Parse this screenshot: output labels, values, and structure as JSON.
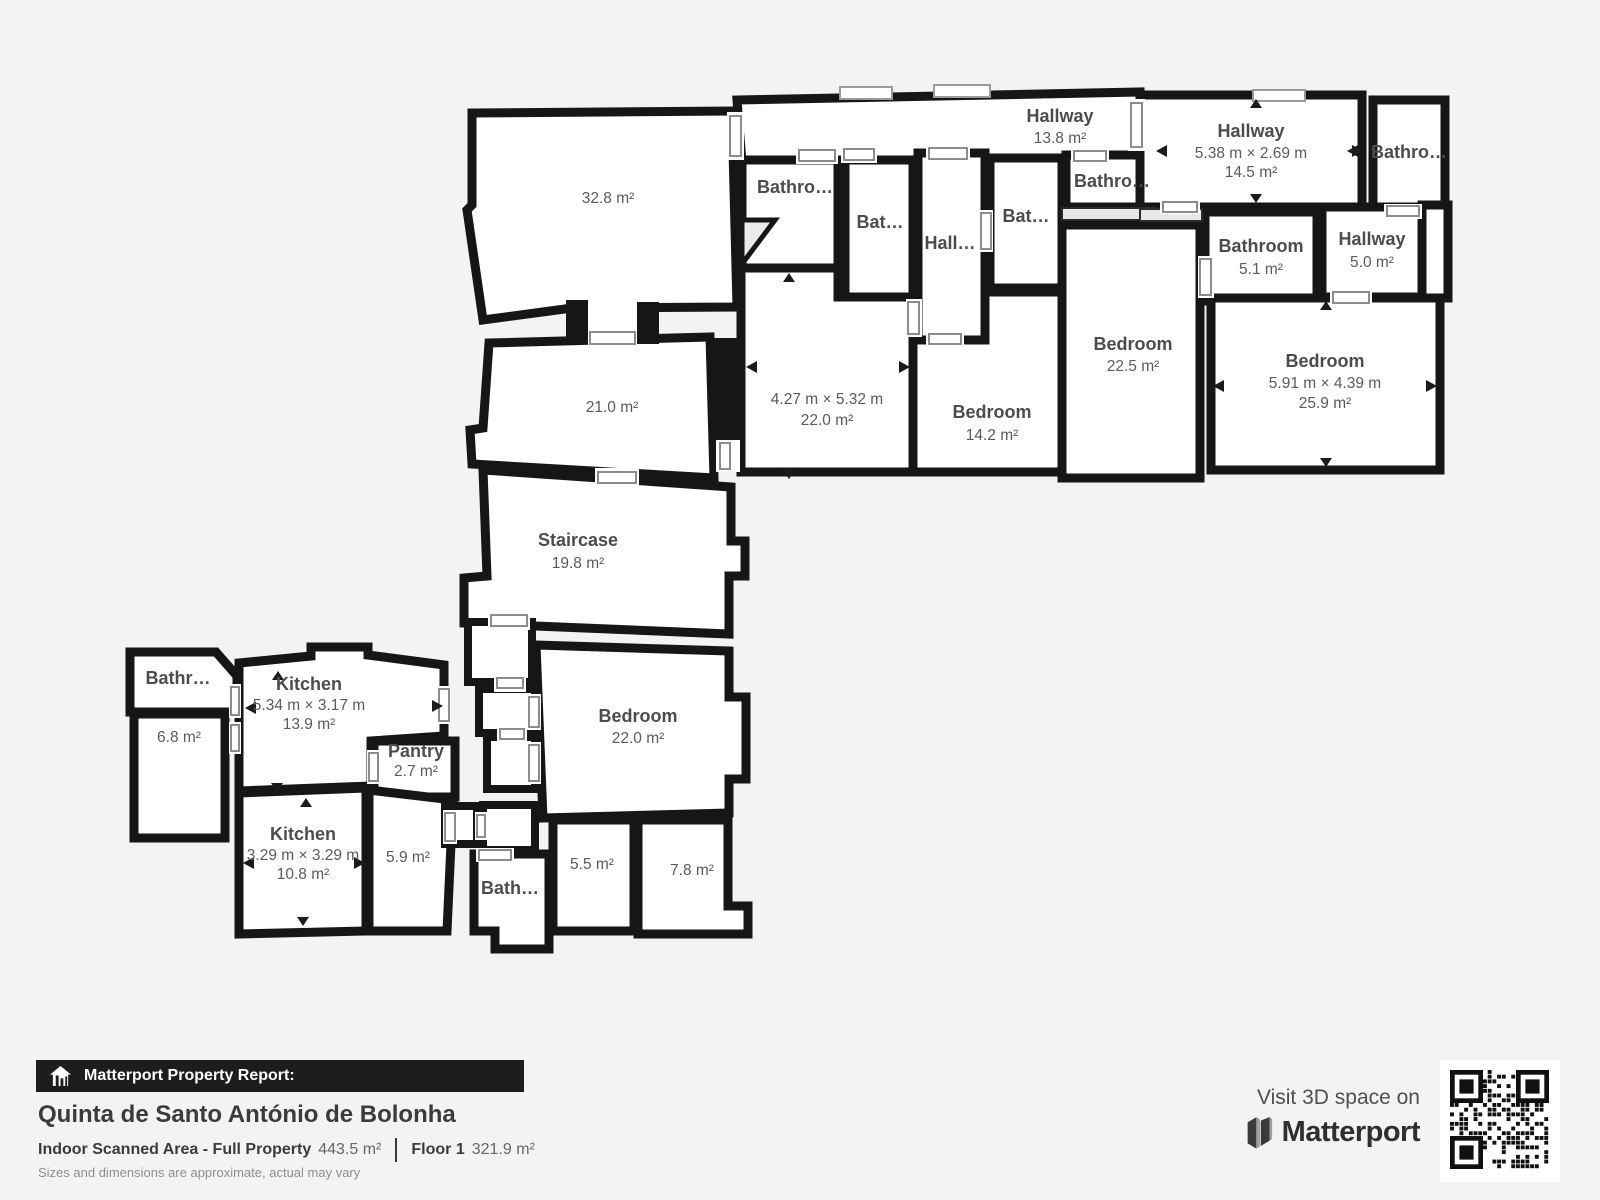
{
  "canvas": {
    "background": "#f4f3f2",
    "wall_color": "#161616",
    "room_fill": "#ffffff",
    "label_color": "#4c4c4c"
  },
  "rooms": [
    {
      "id": "room-32-8",
      "area": "32.8 m²"
    },
    {
      "id": "room-21-0",
      "area": "21.0 m²"
    },
    {
      "id": "staircase",
      "name": "Staircase",
      "area": "19.8 m²"
    },
    {
      "id": "hallway-top",
      "name": "Hallway",
      "area": "13.8 m²"
    },
    {
      "id": "bathroom-strip-left",
      "name": "Bathro…"
    },
    {
      "id": "bath-strip-1",
      "name": "Bat…"
    },
    {
      "id": "hall-corridor",
      "name": "Hall…"
    },
    {
      "id": "bath-strip-2",
      "name": "Bat…"
    },
    {
      "id": "bathroom-strip-right",
      "name": "Bathro…"
    },
    {
      "id": "hallway-right",
      "name": "Hallway",
      "dims": "5.38 m × 2.69 m",
      "area": "14.5 m²"
    },
    {
      "id": "bathroom-top-right",
      "name": "Bathro…"
    },
    {
      "id": "bathroom-5-1",
      "name": "Bathroom",
      "area": "5.1 m²"
    },
    {
      "id": "hallway-5-0",
      "name": "Hallway",
      "area": "5.0 m²"
    },
    {
      "id": "room-22-0",
      "dims": "4.27 m × 5.32 m",
      "area": "22.0 m²"
    },
    {
      "id": "bedroom-14-2",
      "name": "Bedroom",
      "area": "14.2 m²"
    },
    {
      "id": "bedroom-22-5",
      "name": "Bedroom",
      "area": "22.5 m²"
    },
    {
      "id": "bedroom-25-9",
      "name": "Bedroom",
      "dims": "5.91 m × 4.39 m",
      "area": "25.9 m²"
    },
    {
      "id": "bathroom-lower-left",
      "name": "Bathr…"
    },
    {
      "id": "room-6-8",
      "area": "6.8 m²"
    },
    {
      "id": "kitchen-13-9",
      "name": "Kitchen",
      "dims": "5.34 m × 3.17 m",
      "area": "13.9 m²"
    },
    {
      "id": "pantry",
      "name": "Pantry",
      "area": "2.7 m²"
    },
    {
      "id": "kitchen-10-8",
      "name": "Kitchen",
      "dims": "3.29 m × 3.29 m",
      "area": "10.8 m²"
    },
    {
      "id": "room-5-9",
      "area": "5.9 m²"
    },
    {
      "id": "bedroom-22-0",
      "name": "Bedroom",
      "area": "22.0 m²"
    },
    {
      "id": "bath-lower",
      "name": "Bath…"
    },
    {
      "id": "room-5-5",
      "area": "5.5 m²"
    },
    {
      "id": "room-7-8",
      "area": "7.8 m²"
    }
  ],
  "footer": {
    "report_icon": "house-report-icon",
    "report_label": "Matterport Property Report:",
    "property_name": "Quinta de Santo António de Bolonha",
    "area_label": "Indoor Scanned Area - Full Property",
    "area_value": "443.5 m²",
    "floor_label": "Floor 1",
    "floor_value": "321.9 m²",
    "disclaimer": "Sizes and dimensions are approximate, actual may vary"
  },
  "cta": {
    "visit_text": "Visit 3D space on",
    "brand": "Matterport",
    "logo_icon": "matterport-logo-icon",
    "qr": "qr-code"
  }
}
